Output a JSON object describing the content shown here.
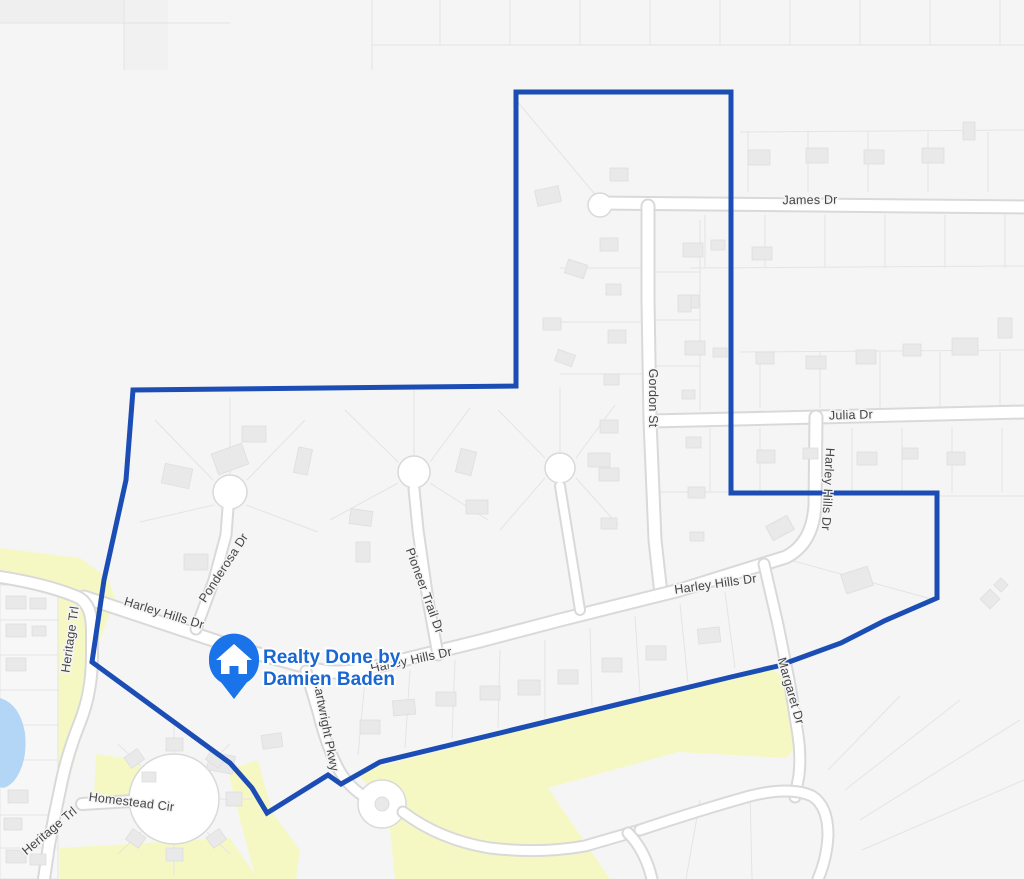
{
  "map": {
    "marker": {
      "icon": "house-pin-icon",
      "label_line1": "Realty Done by",
      "label_line2": "Damien Baden"
    },
    "streets": {
      "james": "James Dr",
      "julia": "Julia Dr",
      "gordon": "Gordon St",
      "harley_hills": "Harley Hills Dr",
      "ponderosa": "Ponderosa Dr",
      "pioneer_trail": "Pioneer Trail Dr",
      "heritage": "Heritage Trl",
      "homestead": "Homestead Cir",
      "cartwright": "Cartwright Pkwy",
      "margaret": "Margaret Dr"
    },
    "colors": {
      "land": "#f5f5f5",
      "park": "#f6f8c4",
      "water": "#b3d5f6",
      "boundary": "#1b4db5",
      "marker_pin": "#1a73e8",
      "marker_text": "#1967d2",
      "street_label": "#454545"
    }
  }
}
